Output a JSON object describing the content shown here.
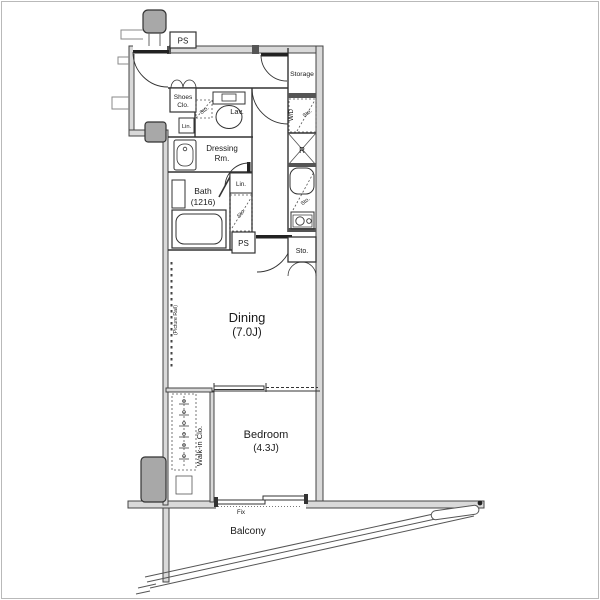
{
  "rooms": {
    "entrance": "Entrance",
    "lav": "Lav.",
    "dressing": [
      "Dressing",
      "Rm."
    ],
    "bath": [
      "Bath",
      "(1216)"
    ],
    "storage": "Storage",
    "dining": [
      "Dining",
      "(7.0J)"
    ],
    "bedroom": [
      "Bedroom",
      "(4.3J)"
    ],
    "walk_in_closet": "Walk-in Clo.",
    "balcony": "Balcony"
  },
  "fixtures": {
    "ps_top": "PS",
    "ps_mid": "PS",
    "shoes_closet": [
      "Shoes",
      "Clo."
    ],
    "linen_upper": "Lin.",
    "linen_bath": "Lin.",
    "sto_toilet": "Sto.",
    "sto_bath": "Sto.",
    "sto_wd": "Sto.",
    "sto_sink": "Sto.",
    "sto_kitchen": "Sto.",
    "washer_dryer": "W/D",
    "refrigerator": "R",
    "fix_window": "Fix",
    "picture_rail": "(Picture Rail)"
  },
  "colors": {
    "wall_fill": "#d9d9d9",
    "line": "#333333",
    "pillar": "#a8a8a8",
    "text": "#1a1a1a"
  }
}
